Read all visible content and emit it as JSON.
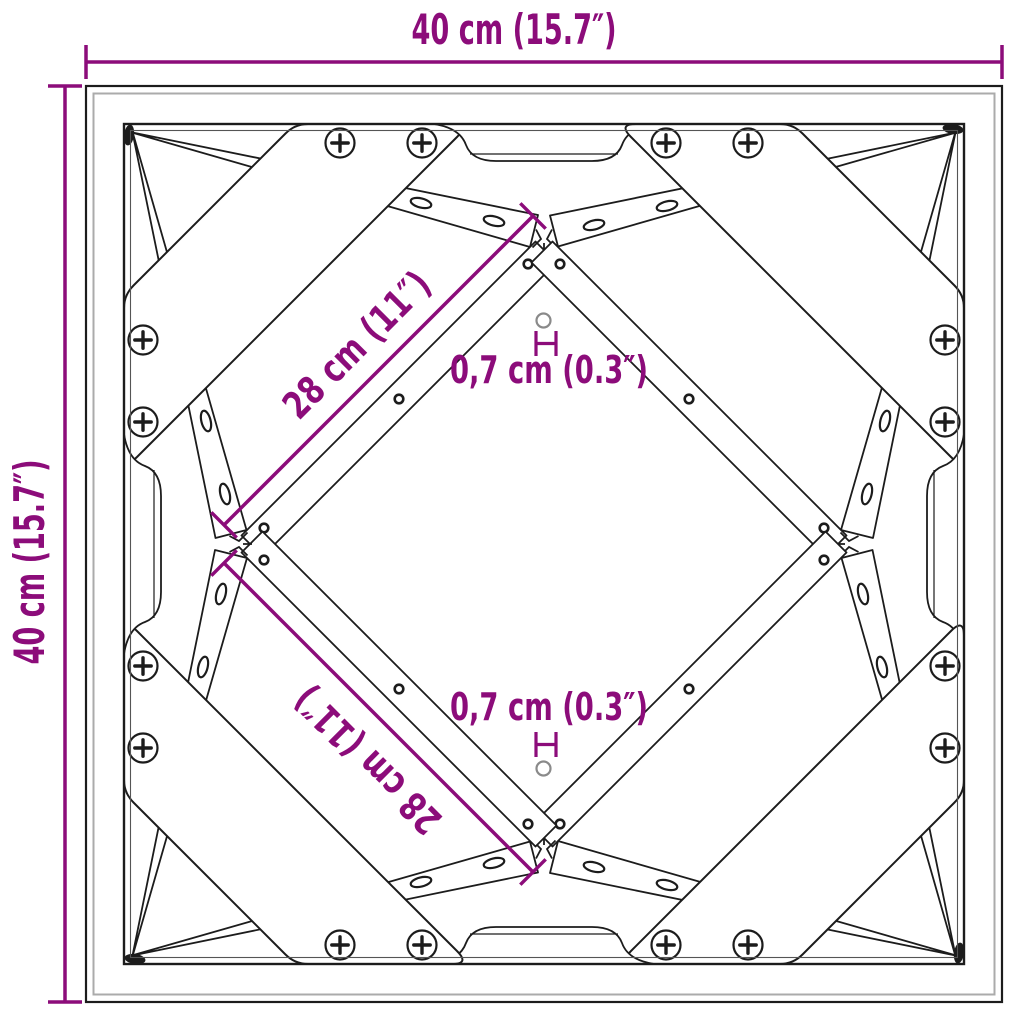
{
  "drawing": {
    "subject": "Square table frame top view — technical dimension drawing",
    "annotations": {
      "width_top": "40 cm (15.7″)",
      "height_left": "40 cm (15.7″)",
      "brace_upper": "28 cm (11″)",
      "brace_lower": "28 cm (11″)",
      "hole_upper": "0,7 cm (0.3″)",
      "hole_lower": "0,7 cm (0.3″)"
    },
    "colors": {
      "dimension": "#8c0c7a",
      "ink": "#1c1c1c",
      "ink_soft": "#555555",
      "edge_gray": "#ababab",
      "hole_gray": "#8a8a8a",
      "background": "#ffffff"
    }
  }
}
